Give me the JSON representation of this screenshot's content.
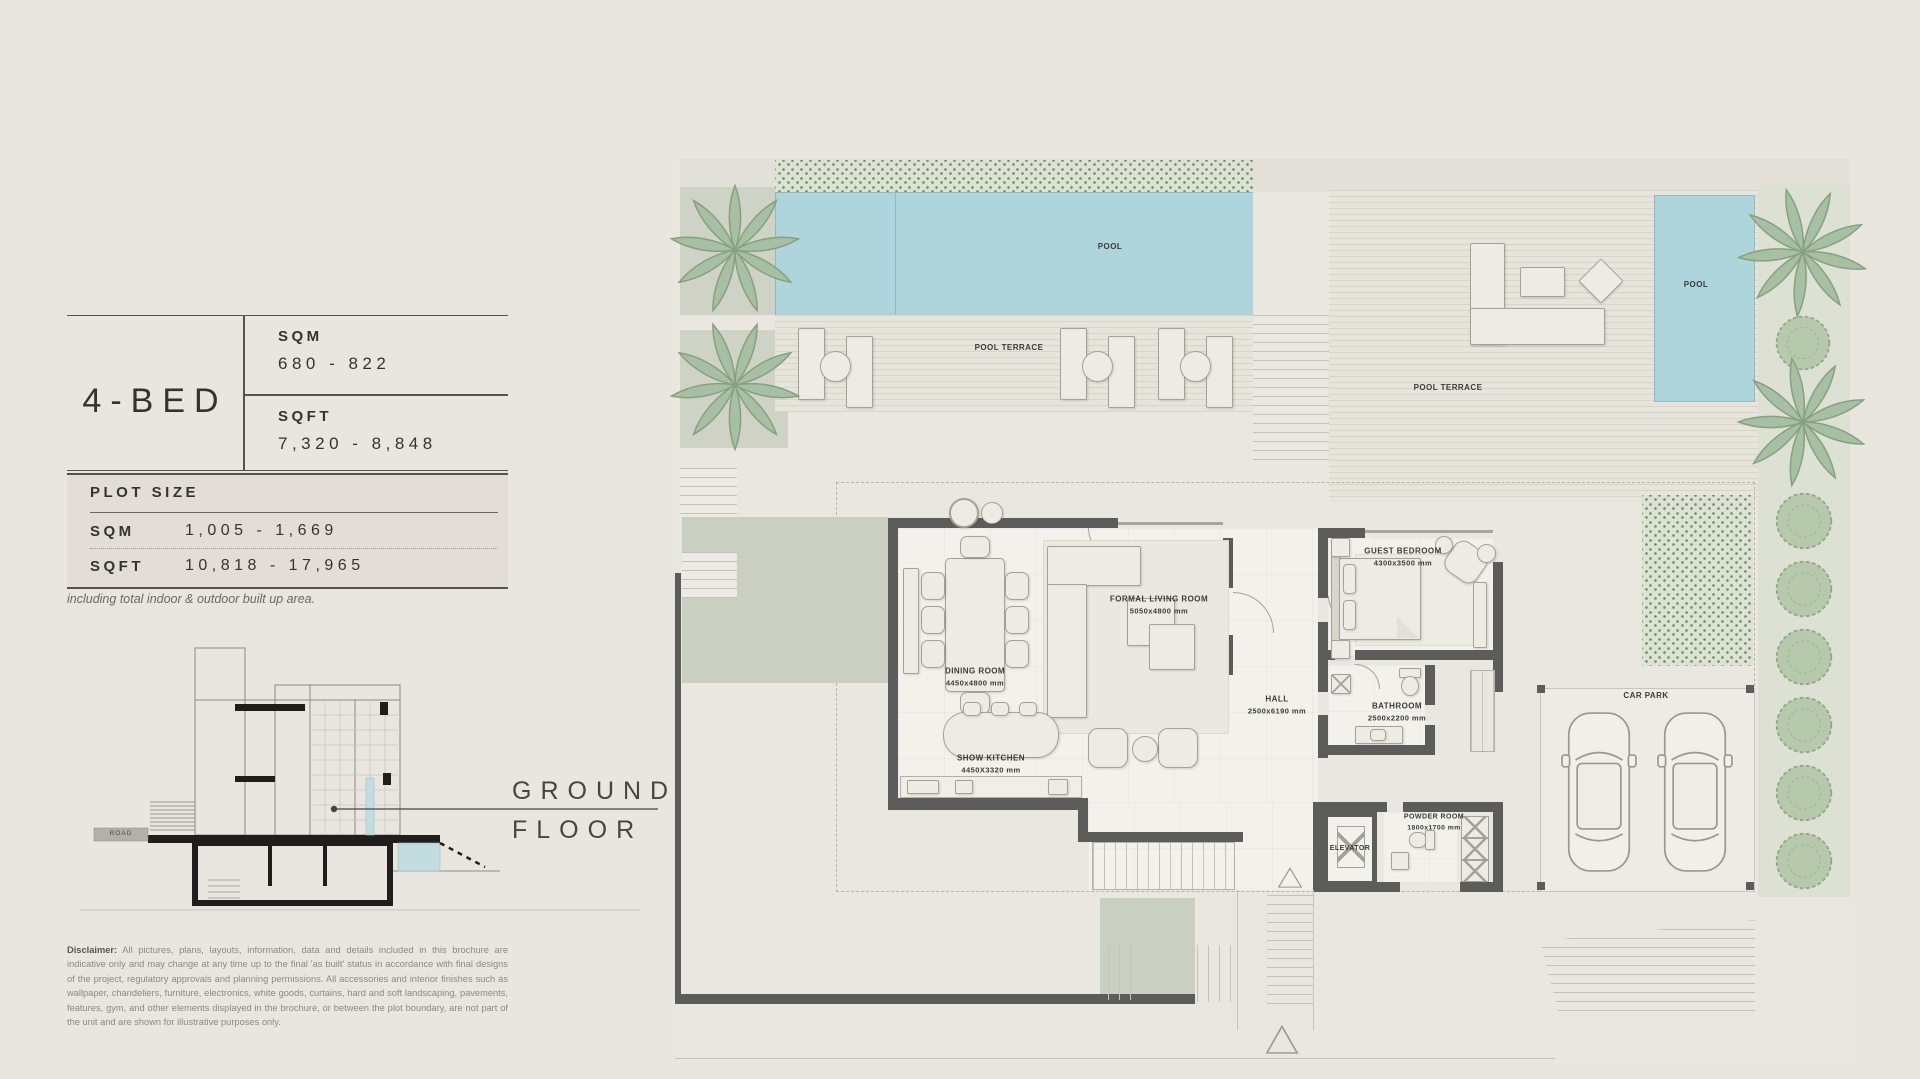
{
  "info_panel": {
    "title": "4-BED",
    "area_table": {
      "sqm_label": "SQM",
      "sqm_value": "680 - 822",
      "sqft_label": "SQFT",
      "sqft_value": "7,320 - 8,848"
    },
    "plot_size": {
      "heading": "PLOT SIZE",
      "sqm_label": "SQM",
      "sqm_value": "1,005 - 1,669",
      "sqft_label": "SQFT",
      "sqft_value": "10,818 - 17,965",
      "note": "including total indoor & outdoor built up area."
    },
    "disclaimer": {
      "label": "Disclaimer:",
      "text": "All pictures, plans, layouts, information, data and details included in this brochure are indicative only and may change at any time up to the final 'as built' status in accordance with final designs of the project, regulatory approvals and planning permissions. All accessories and interior finishes such as wallpaper, chandeliers, furniture, electronics, white goods, curtains, hard and soft landscaping, pavements, features, gym, and other elements displayed in the brochure, or between the plot boundary, are not part of the unit and are shown for illustrative purposes only."
    }
  },
  "section_figure": {
    "road_label": "ROAD",
    "caption_line1": "GROUND",
    "caption_line2": "FLOOR"
  },
  "floor_plan": {
    "pool_top": {
      "label": "POOL"
    },
    "pool_terrace_top": {
      "label": "POOL TERRACE"
    },
    "pool_terrace_right": {
      "label": "POOL TERRACE"
    },
    "pool_right": {
      "label": "POOL"
    },
    "formal_living_room": {
      "label": "FORMAL LIVING ROOM",
      "dims": "5050x4800 mm"
    },
    "dining_room": {
      "label": "DINING ROOM",
      "dims": "4450x4800 mm"
    },
    "show_kitchen": {
      "label": "SHOW KITCHEN",
      "dims": "4450X3320 mm"
    },
    "hall": {
      "label": "HALL",
      "dims": "2500x6190 mm"
    },
    "guest_bedroom": {
      "label": "GUEST BEDROOM",
      "dims": "4300x3500 mm"
    },
    "bathroom": {
      "label": "BATHROOM",
      "dims": "2500x2200 mm"
    },
    "elevator": {
      "label": "ELEVATOR"
    },
    "powder_room": {
      "label": "POWDER ROOM",
      "dims": "1800x1700 mm"
    },
    "car_park": {
      "label": "CAR PARK"
    }
  },
  "colors": {
    "page_bg": "#e9e6e0",
    "pool": "#aed5db",
    "wall": "#5c5c5a",
    "deck": "#e7e4dc",
    "floor": "#f3f1ec",
    "palm": "#a7bfa2",
    "bush": "#b7c9ac",
    "hedge_dot": "#70886b",
    "green_path": "#c9cfc1",
    "label": "#3b3b39",
    "caption": "#4a443e",
    "panel_bg": "#e2ded7"
  }
}
